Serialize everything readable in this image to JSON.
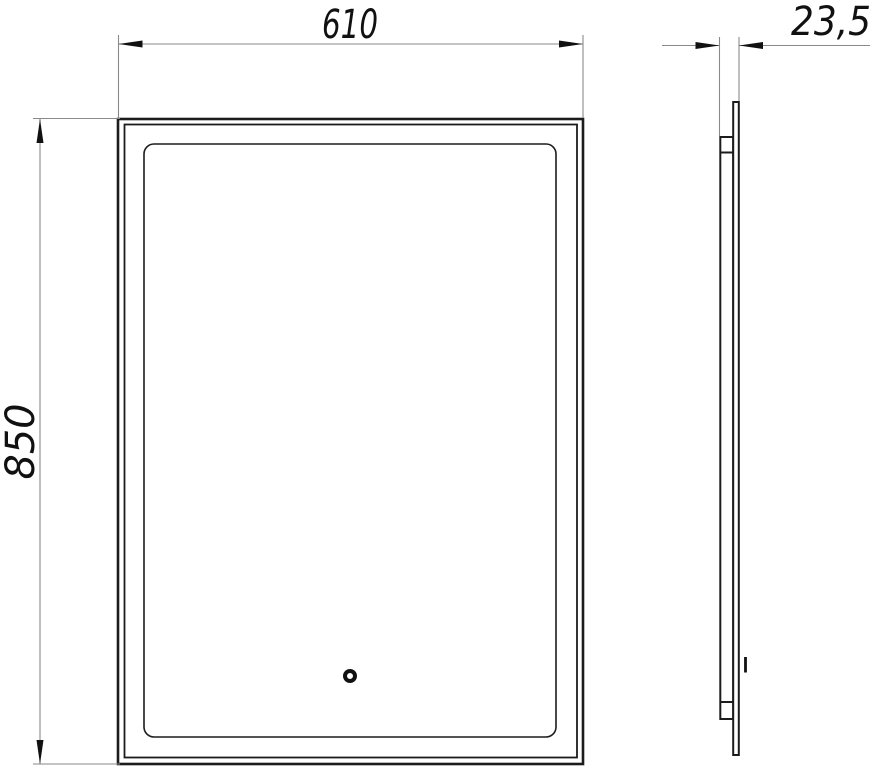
{
  "drawing": {
    "dimensions": {
      "width": {
        "label": "610"
      },
      "height": {
        "label": "850"
      },
      "depth": {
        "label": "23,5"
      }
    },
    "colors": {
      "object_line": "#1c1c1c",
      "dimension_line": "#8a8a8a",
      "text": "#111111",
      "background": "#ffffff"
    }
  }
}
